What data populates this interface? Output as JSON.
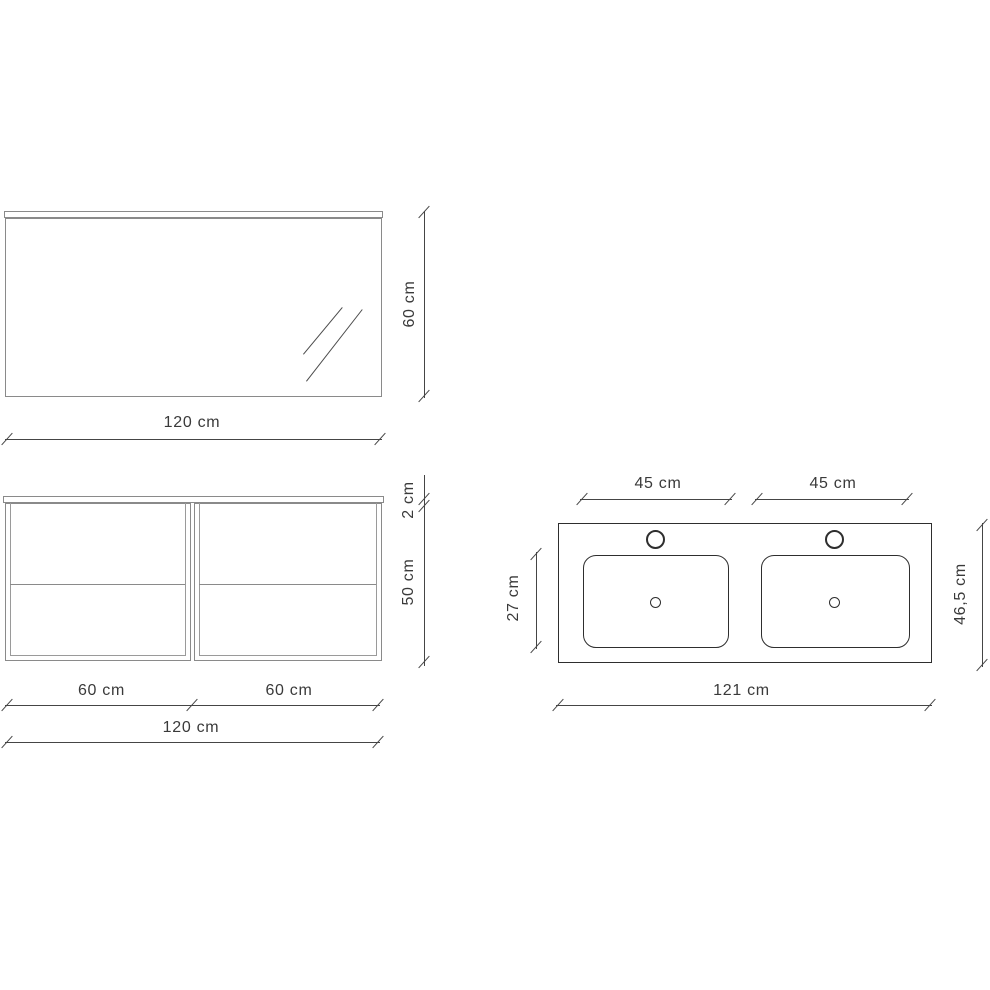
{
  "diagram": {
    "title": "bathroom-furniture-dimension-drawing",
    "colors": {
      "background": "#ffffff",
      "furniture_stroke": "#8a8a8a",
      "fixture_stroke": "#2e2e2e",
      "dimension_stroke": "#454545",
      "label_text": "#3a3a3a"
    },
    "mirror_front_view": {
      "width_label": "120 cm",
      "height_label": "60 cm"
    },
    "cabinet_front_view": {
      "top_thickness_label": "2 cm",
      "body_height_label": "50 cm",
      "left_module_width_label": "60 cm",
      "right_module_width_label": "60 cm",
      "total_width_label": "120 cm"
    },
    "washbasin_top_view": {
      "left_basin_width_label": "45 cm",
      "right_basin_width_label": "45 cm",
      "basin_depth_label": "27 cm",
      "total_depth_label": "46,5 cm",
      "total_width_label": "121 cm"
    }
  }
}
